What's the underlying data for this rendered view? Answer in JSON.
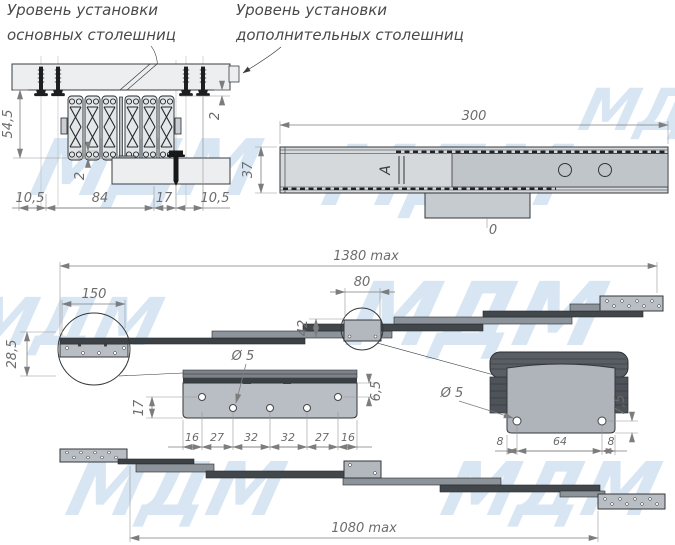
{
  "watermark": {
    "text": "МДМ",
    "color": "#d8e6f4"
  },
  "labels": {
    "main_line1": "Уровень установки",
    "main_line2": "основных столешниц",
    "additional_line1": "Уровень установки",
    "additional_line2": "дополнительных столешниц"
  },
  "annotations": {
    "section_marker": "А",
    "zero_mark": "0"
  },
  "cross_section_view": {
    "total_height": "54,5",
    "gap_top": "2",
    "gap_bottom": "2",
    "bottom_dims": [
      "10,5",
      "84",
      "17",
      "10,5"
    ]
  },
  "closed_view": {
    "length": "300",
    "height": "37"
  },
  "extended_top_view": {
    "total_length": "1380 max",
    "end_plate_length": "150",
    "bracket_length": "80",
    "bracket_height": "42",
    "end_height": "28,5"
  },
  "left_plate_detail": {
    "hole_diameter": "Ø 5",
    "hole_row_offset": "17",
    "top_edge_offset": "6,5",
    "spacings": [
      "16",
      "27",
      "32",
      "32",
      "27",
      "16"
    ]
  },
  "right_bracket_detail": {
    "hole_diameter": "Ø 5",
    "bottom_offset": "7,5",
    "spacings": [
      "8",
      "64",
      "8"
    ]
  },
  "extended_bottom_view": {
    "total_length": "1080 max"
  }
}
